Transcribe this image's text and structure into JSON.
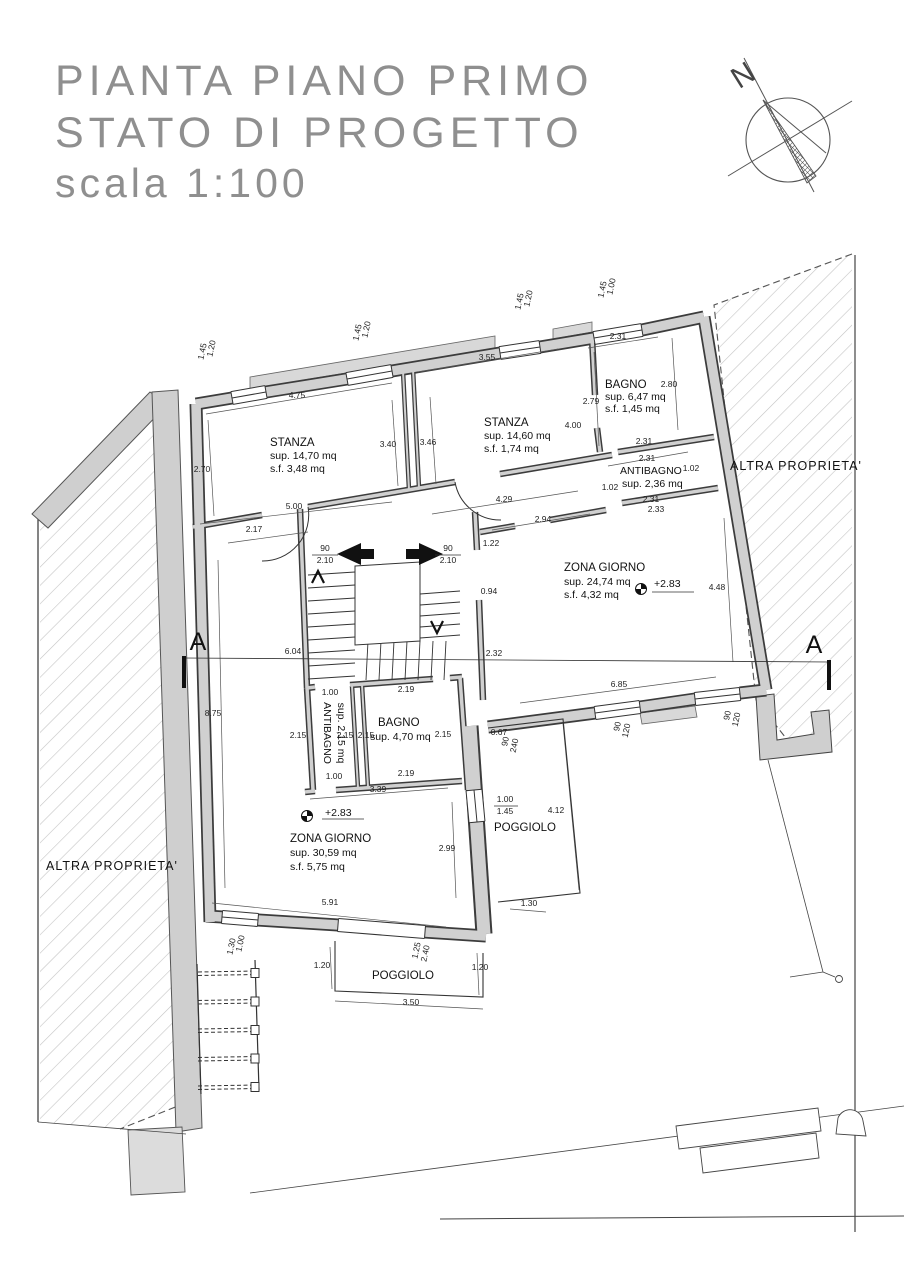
{
  "title": {
    "line1": "PIANTA PIANO PRIMO",
    "line2": "STATO DI PROGETTO",
    "line3": "scala 1:100"
  },
  "compass": {
    "north_label": "N"
  },
  "section": {
    "marker_left": "A",
    "marker_right": "A"
  },
  "rooms": {
    "stanza1": {
      "name": "STANZA",
      "sup": "sup. 14,70 mq",
      "sf": "s.f.  3,48 mq"
    },
    "stanza2": {
      "name": "STANZA",
      "sup": "sup. 14,60 mq",
      "sf": "s.f. 1,74 mq"
    },
    "bagno1": {
      "name": "BAGNO",
      "sup": "sup. 6,47 mq",
      "sf": "s.f. 1,45 mq"
    },
    "antibagno1": {
      "name": "ANTIBAGNO",
      "sup": "sup. 2,36 mq"
    },
    "zona_giorno_1": {
      "name": "ZONA GIORNO",
      "sup": "sup. 24,74 mq",
      "sf": "s.f. 4,32 mq",
      "level": "+2.83"
    },
    "antibagno2": {
      "name": "ANTIBAGNO",
      "sup": "sup. 2,15 mq"
    },
    "bagno2": {
      "name": "BAGNO",
      "sup": "sup. 4,70 mq"
    },
    "zona_giorno_2": {
      "name": "ZONA GIORNO",
      "sup": "sup. 30,59 mq",
      "sf": "s.f. 5,75 mq",
      "level": "+2.83"
    },
    "poggiolo_right": {
      "name": "POGGIOLO"
    },
    "poggiolo_bottom": {
      "name": "POGGIOLO"
    },
    "altra_proprieta_left": {
      "name": "ALTRA PROPRIETA'"
    },
    "altra_proprieta_right": {
      "name": "ALTRA PROPRIETA'"
    }
  },
  "dims": {
    "w1_top": "1.20",
    "w1_bot": "1.45",
    "w2_top": "1.20",
    "w2_bot": "1.45",
    "w3_top": "1.20",
    "w3_bot": "1.45",
    "w4_top": "1.00",
    "w4_bot": "1.45",
    "s1_top": "4.75",
    "s1_left": "2.70",
    "s1_right": "3.40",
    "s1_bottom": "5.00",
    "s1_below": "2.17",
    "s2_top": "3.55",
    "s2_left": "3.46",
    "s2_right_up": "2.79",
    "s2_right_low": "4.00",
    "s2_bottom": "4.29",
    "b1_top": "2.31",
    "b1_right": "2.80",
    "b1_bottom": "2.31",
    "ab1_top": "2.31",
    "ab1_left": "1.02",
    "ab1_right": "1.02",
    "ab1_bottom": "2.31",
    "ab1_below": "2.33",
    "zg1_top": "2.94",
    "zg1_side1": "1.22",
    "zg1_side2": "0.94",
    "zg1_right": "4.48",
    "zg1_side3": "2.32",
    "zg1_bottom": "6.85",
    "zgw1_w": "90",
    "zgw1_h": "120",
    "zgw2_w": "90",
    "zgw2_h": "120",
    "door_left_w": "90",
    "door_left_h": "2.10",
    "door_right_w": "90",
    "door_right_h": "2.10",
    "hall_d1": "1.00",
    "hall_d2": "2.19",
    "ab2_side_l": "2.15",
    "ab2_side_r": "2.15",
    "b2_side_l": "2.15",
    "b2_side_r": "2.15",
    "ab2_bottom": "1.00",
    "b2_bottom": "2.19",
    "row3_total": "3.39",
    "pr_gap": "0.67",
    "pr_door_w": "90",
    "pr_door_h": "240",
    "pr_win_top": "1.00",
    "pr_win_bot": "1.45",
    "pr_len": "4.12",
    "pr_edge": "1.30",
    "zg2_wall": "2.99",
    "zg2_bottom": "5.91",
    "left_wall": "8.75",
    "section_len": "6.04",
    "blw_top": "1.00",
    "blw_bot": "1.30",
    "pb_left": "1.20",
    "pb_door_top": "1.25",
    "pb_door_bot": "2.40",
    "pb_right": "1.20",
    "pb_bottom": "3.50"
  },
  "colors": {
    "wall_fill": "#d0d0d0",
    "wall_line": "#3c3c3c",
    "thin_line": "#333333",
    "hatch_line": "#c4c4c4",
    "title_gray": "#8f8f8f"
  }
}
